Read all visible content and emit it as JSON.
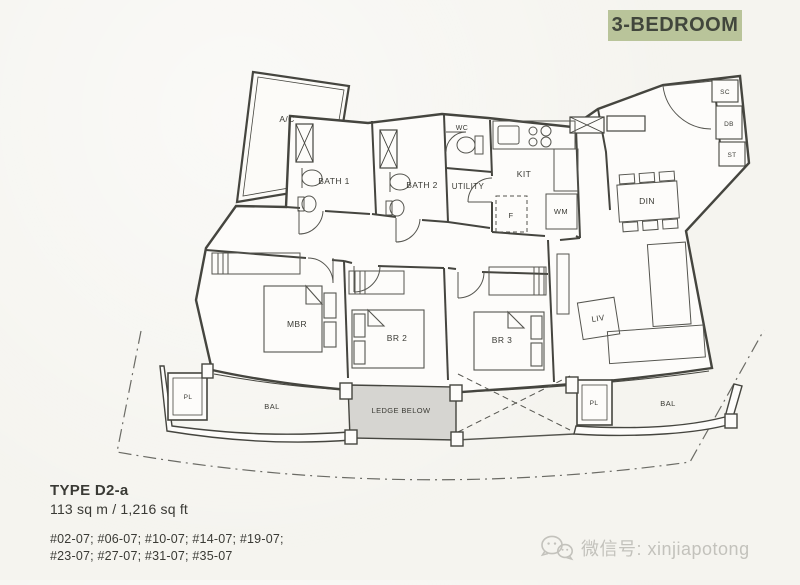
{
  "badge": {
    "label": "3-BEDROOM",
    "bg": "#b9c49a",
    "fg": "#41463c"
  },
  "plan": {
    "rooms": {
      "ac": "A/C",
      "bath1": "BATH 1",
      "bath2": "BATH 2",
      "wc": "WC",
      "utility": "UTILITY",
      "kit": "KIT",
      "fridge": "F",
      "wm": "WM",
      "din": "DIN",
      "sc": "SC",
      "db": "DB",
      "st": "ST",
      "mbr": "MBR",
      "br2": "BR 2",
      "br3": "BR 3",
      "liv": "LIV",
      "pl": "PL",
      "bal": "BAL",
      "ledge": "LEDGE BELOW"
    }
  },
  "info": {
    "type": "TYPE D2-a",
    "area": "113 sq m / 1,216 sq ft",
    "units_line1": "#02-07; #06-07; #10-07; #14-07; #19-07;",
    "units_line2": "#23-07; #27-07; #31-07; #35-07"
  },
  "watermark": {
    "label": "微信号: xinjiapotong"
  },
  "colors": {
    "paper": "#f5f4ef",
    "line": "#45453f",
    "ledge_fill": "#d6d5d1",
    "badge_bg": "#b9c49a",
    "watermark": "#c3c2bc"
  }
}
